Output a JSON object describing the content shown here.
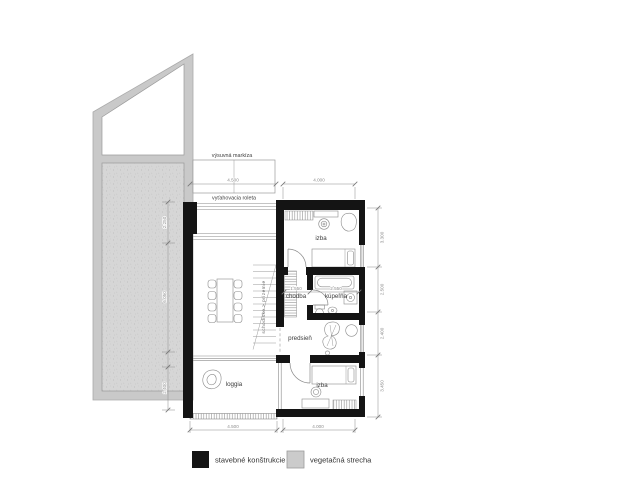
{
  "plan": {
    "annotations": {
      "awning": "výsuvná markíza",
      "roller_blind": "vyťahovacia roleta"
    },
    "rooms": {
      "bedroom_north": "izba",
      "hall": "chodba",
      "bathroom": "kúpeľňa",
      "entry": "predsieň",
      "bedroom_south": "izba",
      "loggia": "loggia",
      "stairs": "schodisko > prízemie"
    },
    "dimensions": {
      "awning_width": "4.500",
      "north_width": "4.000",
      "south_left_width": "4.500",
      "south_right_width": "4.000",
      "hall_width": "1.550",
      "bath_width": "2.550",
      "west_segments": [
        "2.250",
        "6.050",
        "2.400"
      ],
      "east_segments": [
        "3.300",
        "2.500",
        "2.400",
        "3.450"
      ]
    }
  },
  "legend": {
    "items": [
      {
        "label": "stavebné konštrukcie",
        "color": "#141414"
      },
      {
        "label": "vegetačná strecha",
        "color": "#cbcbcb"
      }
    ]
  },
  "colors": {
    "wall": "#141414",
    "roof_band": "#c9c9c9",
    "roof_surface": "#d6d6d6",
    "line": "#8a8a8a"
  }
}
